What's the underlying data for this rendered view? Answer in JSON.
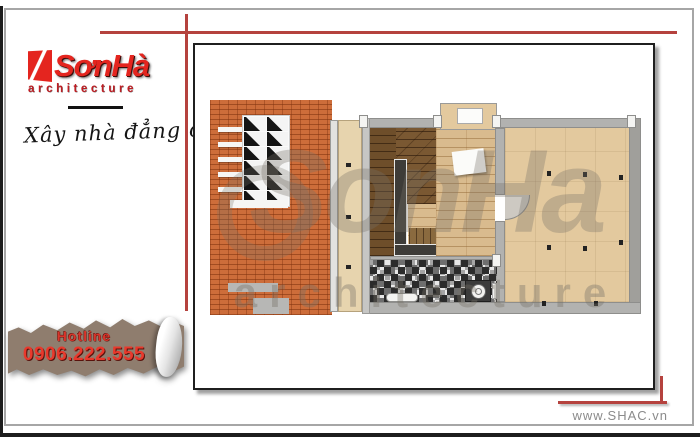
{
  "brand": {
    "logo_text": "SơnHà",
    "logo_sub": "architecture",
    "tagline": "Xây nhà đẳng cấp"
  },
  "hotline": {
    "label": "Hotline",
    "number": "0906.222.555"
  },
  "footer": {
    "website": "www.SHAC.vn"
  },
  "watermark": {
    "main": "SonHa",
    "sub": "architecture"
  },
  "colors": {
    "brand_red": "#e4251f",
    "accent_line_red": "#b5423e",
    "hotline_red": "#e8392c",
    "banner_brown": "#8f7d6e",
    "brick_orange": "#cd6d3a",
    "wood_floor": "#d9bb8e",
    "tan_floor": "#e3c99e",
    "stair_brown": "#7a5832",
    "wall_gray": "#b2b2b0",
    "stair_core_gray": "#3e3c38"
  }
}
